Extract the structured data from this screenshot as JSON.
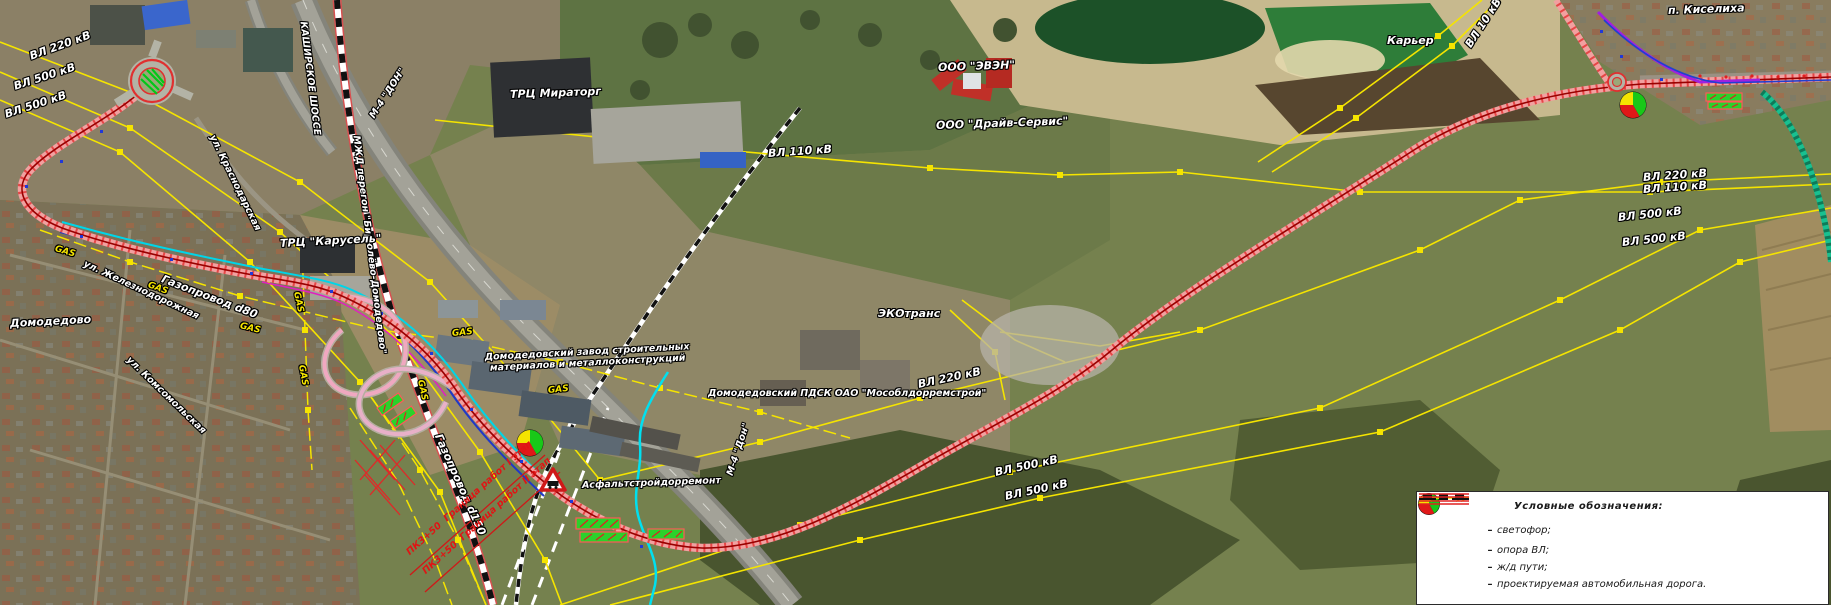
{
  "map": {
    "labels": [
      {
        "name": "lbl-vl220-topleft",
        "text": "ВЛ 220 кВ",
        "x": 30,
        "y": 50,
        "rot": -20,
        "cls": "wl"
      },
      {
        "name": "lbl-vl500-topleft-1",
        "text": "ВЛ 500 кВ",
        "x": 14,
        "y": 80,
        "rot": -18,
        "cls": "wl"
      },
      {
        "name": "lbl-vl500-topleft-2",
        "text": "ВЛ 500 кВ",
        "x": 5,
        "y": 108,
        "rot": -18,
        "cls": "wl"
      },
      {
        "name": "lbl-kashirskoe-shosse",
        "text": "КАШИРСКОЕ ШОССЕ",
        "x": 303,
        "y": 16,
        "rot": 83,
        "cls": "sm"
      },
      {
        "name": "lbl-m4-don-top",
        "text": "М-4 \"ДОН\"",
        "x": 372,
        "y": 112,
        "rot": -57,
        "cls": "sm"
      },
      {
        "name": "lbl-mzd-peregon",
        "text": "МЖД перегон \"Бирюлёво-Домодедово\"",
        "x": 356,
        "y": 130,
        "rot": 83,
        "cls": "sm"
      },
      {
        "name": "lbl-ul-krasnodarskaya",
        "text": "ул. Краснодарская",
        "x": 212,
        "y": 130,
        "rot": 64,
        "cls": "sm"
      },
      {
        "name": "lbl-trc-miratorg",
        "text": "ТРЦ Мираторг",
        "x": 510,
        "y": 88,
        "rot": -2,
        "cls": ""
      },
      {
        "name": "lbl-vl110-top",
        "text": "ВЛ 110 кВ",
        "x": 768,
        "y": 147,
        "rot": -4,
        "cls": ""
      },
      {
        "name": "lbl-ooo-even",
        "text": "ООО \"ЭВЭН\"",
        "x": 938,
        "y": 61,
        "rot": -2,
        "cls": ""
      },
      {
        "name": "lbl-ooo-drive-service",
        "text": "ООО \"Драйв-Сервис\"",
        "x": 936,
        "y": 119,
        "rot": -2,
        "cls": ""
      },
      {
        "name": "lbl-karier",
        "text": "Карьер",
        "x": 1387,
        "y": 34,
        "rot": 0,
        "cls": ""
      },
      {
        "name": "lbl-vl10",
        "text": "ВЛ 10 кВ",
        "x": 1468,
        "y": 40,
        "rot": -57,
        "cls": ""
      },
      {
        "name": "lbl-p-kiselikha",
        "text": "п. Киселиха",
        "x": 1668,
        "y": 4,
        "rot": -2,
        "cls": ""
      },
      {
        "name": "lbl-vl220-right",
        "text": "ВЛ 220 кВ",
        "x": 1643,
        "y": 171,
        "rot": -4,
        "cls": ""
      },
      {
        "name": "lbl-vl110-right",
        "text": "ВЛ 110 кВ",
        "x": 1643,
        "y": 183,
        "rot": -4,
        "cls": ""
      },
      {
        "name": "lbl-vl500-right-1",
        "text": "ВЛ 500 кВ",
        "x": 1618,
        "y": 211,
        "rot": -6,
        "cls": ""
      },
      {
        "name": "lbl-vl500-right-2",
        "text": "ВЛ 500 кВ",
        "x": 1622,
        "y": 236,
        "rot": -6,
        "cls": ""
      },
      {
        "name": "lbl-vl220-bottom",
        "text": "ВЛ 220 кВ",
        "x": 918,
        "y": 378,
        "rot": -12,
        "cls": ""
      },
      {
        "name": "lbl-vl500-bottom-1",
        "text": "ВЛ 500 кВ",
        "x": 995,
        "y": 466,
        "rot": -12,
        "cls": ""
      },
      {
        "name": "lbl-vl500-bottom-2",
        "text": "ВЛ 500 кВ",
        "x": 1005,
        "y": 490,
        "rot": -12,
        "cls": ""
      },
      {
        "name": "lbl-domodedovsky-zavod",
        "text": "Домодедовский завод строительных\nматериалов и металлоконструкций",
        "x": 485,
        "y": 352,
        "rot": -3,
        "cls": "sm"
      },
      {
        "name": "lbl-domodedovsky-pdsk",
        "text": "Домодедовский ПДСК ОАО \"Мособлдорремстрой\"",
        "x": 708,
        "y": 388,
        "rot": 0,
        "cls": "sm"
      },
      {
        "name": "lbl-ecotrans",
        "text": "ЭКОтранс",
        "x": 878,
        "y": 307,
        "rot": 0,
        "cls": ""
      },
      {
        "name": "lbl-asphaltstroydorremont",
        "text": "Асфальтстройдорремонт",
        "x": 582,
        "y": 480,
        "rot": -2,
        "cls": "sm"
      },
      {
        "name": "lbl-gazoprovod-d80",
        "text": "Газопровод d80",
        "x": 162,
        "y": 272,
        "rot": 21,
        "cls": ""
      },
      {
        "name": "lbl-gazoprovod-d150",
        "text": "Газопровод d150",
        "x": 438,
        "y": 428,
        "rot": 66,
        "cls": ""
      },
      {
        "name": "lbl-ul-zheleznodorozhnaya",
        "text": "ул. Железнодорожная",
        "x": 84,
        "y": 258,
        "rot": 25,
        "cls": "sm"
      },
      {
        "name": "lbl-domodedovo",
        "text": "Домодедово",
        "x": 10,
        "y": 317,
        "rot": -3,
        "cls": ""
      },
      {
        "name": "lbl-ul-komsomolskaya",
        "text": "ул. Комсомольская",
        "x": 128,
        "y": 353,
        "rot": 44,
        "cls": "sm"
      },
      {
        "name": "lbl-trc-karusel",
        "text": "ТРЦ \"Карусель\"",
        "x": 280,
        "y": 237,
        "rot": -3,
        "cls": ""
      },
      {
        "name": "lbl-m4-don-bottom",
        "text": "М-4 \"Дон\"",
        "x": 730,
        "y": 470,
        "rot": -72,
        "cls": "sm"
      },
      {
        "name": "lbl-granica-rabot-1",
        "text": "ПК3+50  Граница работ I этап",
        "x": 408,
        "y": 548,
        "rot": -42,
        "cls": "rl"
      },
      {
        "name": "lbl-granica-rabot-2",
        "text": "ПК3+50  Граница работ II этап",
        "x": 424,
        "y": 567,
        "rot": -42,
        "cls": "rl"
      },
      {
        "name": "lbl-gas-1",
        "text": "GAS",
        "x": 55,
        "y": 244,
        "rot": 16,
        "cls": "gl"
      },
      {
        "name": "lbl-gas-2",
        "text": "GAS",
        "x": 148,
        "y": 280,
        "rot": 20,
        "cls": "gl"
      },
      {
        "name": "lbl-gas-3",
        "text": "GAS",
        "x": 240,
        "y": 321,
        "rot": 14,
        "cls": "gl"
      },
      {
        "name": "lbl-gas-4",
        "text": "GAS",
        "x": 296,
        "y": 287,
        "rot": 78,
        "cls": "gl"
      },
      {
        "name": "lbl-gas-5",
        "text": "GAS",
        "x": 301,
        "y": 360,
        "rot": 80,
        "cls": "gl"
      },
      {
        "name": "lbl-gas-6",
        "text": "GAS",
        "x": 452,
        "y": 329,
        "rot": -6,
        "cls": "gl"
      },
      {
        "name": "lbl-gas-7",
        "text": "GAS",
        "x": 420,
        "y": 375,
        "rot": 78,
        "cls": "gl"
      },
      {
        "name": "lbl-gas-8",
        "text": "GAS",
        "x": 548,
        "y": 386,
        "rot": -6,
        "cls": "gl"
      }
    ]
  },
  "legend": {
    "title": "Условные обозначения:",
    "dash": "–",
    "items": [
      {
        "symbol": "traffic-light",
        "label": "светофор;"
      },
      {
        "symbol": "power-tower",
        "label": "опора ВЛ;"
      },
      {
        "symbol": "railway",
        "label": "ж/д пути;"
      },
      {
        "symbol": "projected-road",
        "label": "проектируемая автомобильная дорога."
      }
    ]
  },
  "colors": {
    "power_line": "#f5e400",
    "projected_road": "#e02020",
    "railway": "#111111",
    "gas_line": "#f5e400",
    "stream": "#00e0f0",
    "traffic_green": "#18c818",
    "traffic_yellow": "#f5e400",
    "traffic_red": "#e01818"
  }
}
